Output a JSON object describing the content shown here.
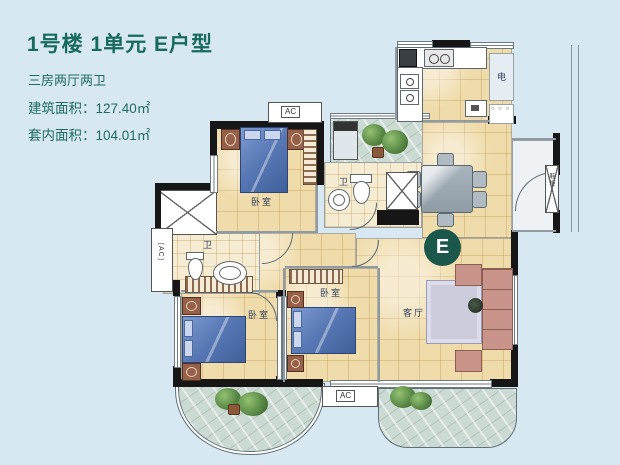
{
  "header": {
    "title": "1号楼 1单元 E户型",
    "subtitle": "三房两厅两卫",
    "area_building": "建筑面积：127.40㎡",
    "area_inner": "套内面积：104.01㎡"
  },
  "plan": {
    "badge": "E",
    "bedroom1_label": "卧室",
    "bedroom2_label": "卧室",
    "bedroom3_label": "卧室",
    "living_label": "客厅",
    "bath1_label": "卫",
    "bath2_label": "卫",
    "electric_label": "电",
    "ac_top": "AC",
    "ac_bottom": "AC",
    "ac_left": "〔AC〕",
    "entry_cabinet": "鞋柜",
    "cabinet_dots": "○ ○ ○"
  },
  "colors": {
    "background": "#d8e8f2",
    "title_green": "#176a5e",
    "floor_tan": "#f0dcab",
    "wall_black": "#161616",
    "bed_blue": "#5878b5",
    "balcony_stone": "#cbdad2",
    "badge_green": "#1b584b"
  }
}
